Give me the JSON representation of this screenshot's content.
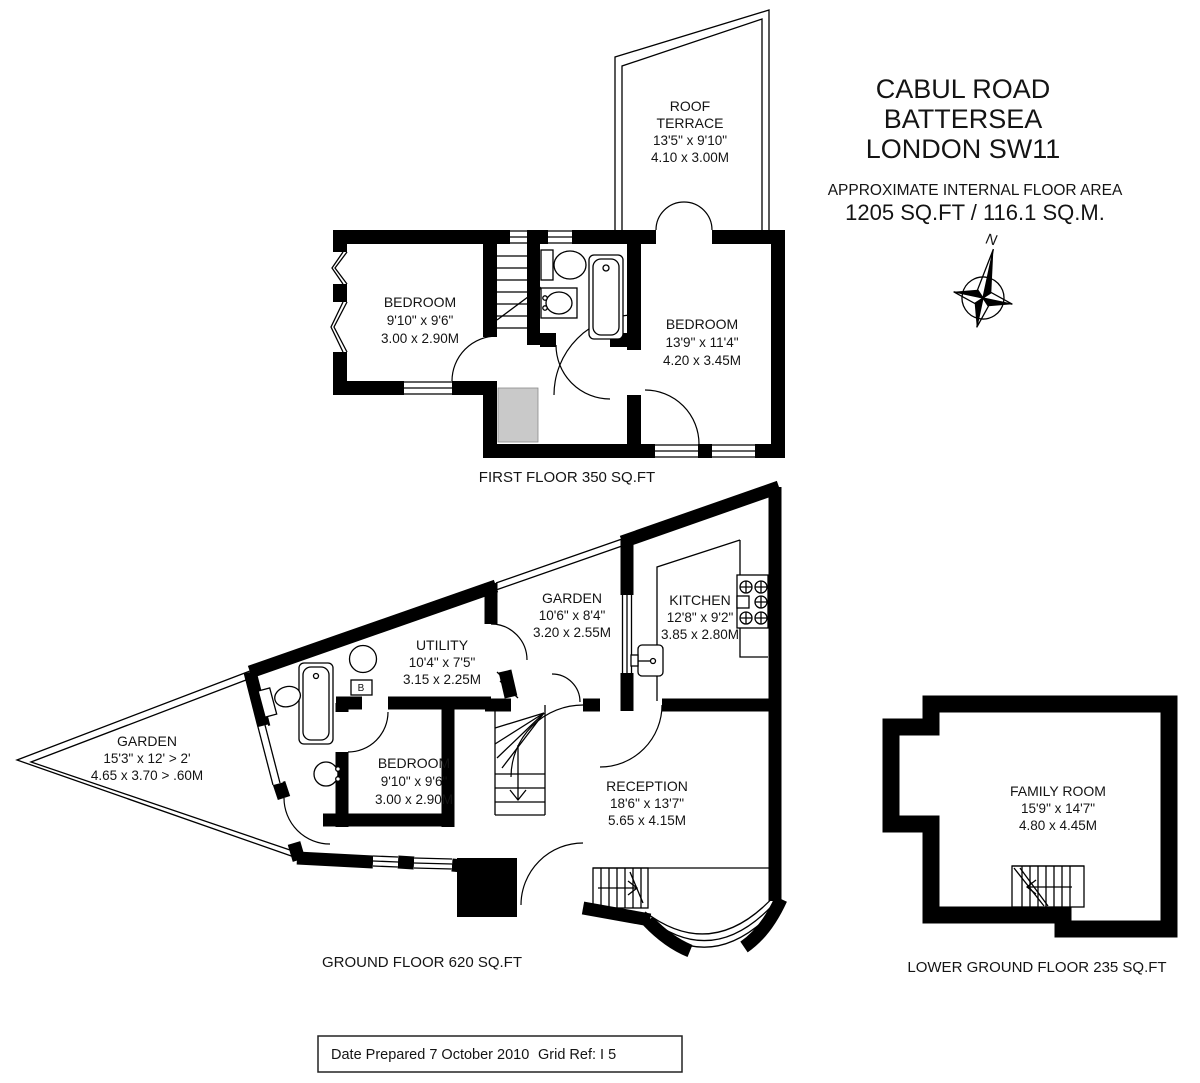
{
  "title": {
    "line1": "CABUL ROAD",
    "line2": "BATTERSEA",
    "line3": "LONDON SW11"
  },
  "area": {
    "label": "APPROXIMATE INTERNAL FLOOR AREA",
    "value": "1205 SQ.FT / 116.1 SQ.M."
  },
  "compass": {
    "north_label": "N"
  },
  "floors": {
    "first": {
      "label": "FIRST FLOOR 350 SQ.FT",
      "rooms": {
        "roof_terrace": {
          "name_line1": "ROOF",
          "name_line2": "TERRACE",
          "imperial": "13'5\" x 9'10\"",
          "metric": "4.10 x 3.00M"
        },
        "bedroom_left": {
          "name": "BEDROOM",
          "imperial": "9'10\" x 9'6\"",
          "metric": "3.00 x 2.90M"
        },
        "bedroom_right": {
          "name": "BEDROOM",
          "imperial": "13'9\" x 11'4\"",
          "metric": "4.20 x 3.45M"
        }
      }
    },
    "ground": {
      "label": "GROUND FLOOR 620 SQ.FT",
      "boiler_label": "B",
      "rooms": {
        "garden_rear": {
          "name": "GARDEN",
          "imperial": "15'3\" x 12' > 2'",
          "metric": "4.65 x 3.70 > .60M"
        },
        "utility": {
          "name": "UTILITY",
          "imperial": "10'4\" x 7'5\"",
          "metric": "3.15 x 2.25M"
        },
        "garden_court": {
          "name": "GARDEN",
          "imperial": "10'6\" x 8'4\"",
          "metric": "3.20 x 2.55M"
        },
        "kitchen": {
          "name": "KITCHEN",
          "imperial": "12'8\" x 9'2\"",
          "metric": "3.85 x 2.80M"
        },
        "bedroom": {
          "name": "BEDROOM",
          "imperial": "9'10\" x 9'6\"",
          "metric": "3.00 x 2.90M"
        },
        "reception": {
          "name": "RECEPTION",
          "imperial": "18'6\" x 13'7\"",
          "metric": "5.65 x 4.15M"
        }
      }
    },
    "lower": {
      "label": "LOWER GROUND FLOOR 235 SQ.FT",
      "rooms": {
        "family": {
          "name": "FAMILY ROOM",
          "imperial": "15'9\" x 14'7\"",
          "metric": "4.80 x 4.45M"
        }
      }
    }
  },
  "footer": {
    "date_prepared": "Date Prepared 7 October 2010",
    "grid_ref": "Grid Ref: I 5"
  },
  "colors": {
    "ink": "#000000",
    "landing_gray": "#c9c9c9"
  }
}
